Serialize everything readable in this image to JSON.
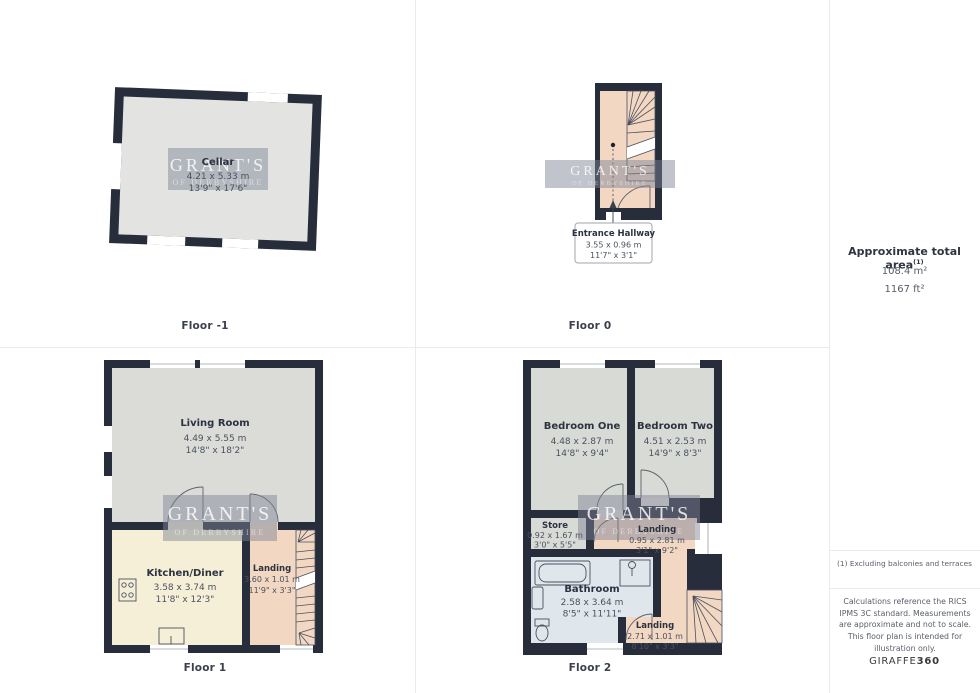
{
  "watermark": {
    "line1": "GRANT'S",
    "line2": "OF DERBYSHIRE"
  },
  "floors": {
    "fm1": {
      "label": "Floor -1",
      "rooms": {
        "cellar": {
          "name": "Cellar",
          "metric": "4.21 x 5.33 m",
          "imperial": "13'9\" x 17'6\""
        }
      }
    },
    "f0": {
      "label": "Floor 0",
      "rooms": {
        "entrance_hallway": {
          "name": "Entrance Hallway",
          "metric": "3.55 x 0.96 m",
          "imperial": "11'7\" x 3'1\""
        }
      }
    },
    "f1": {
      "label": "Floor 1",
      "rooms": {
        "living_room": {
          "name": "Living Room",
          "metric": "4.49 x 5.55 m",
          "imperial": "14'8\" x 18'2\""
        },
        "kitchen_diner": {
          "name": "Kitchen/Diner",
          "metric": "3.58 x 3.74 m",
          "imperial": "11'8\" x 12'3\""
        },
        "landing": {
          "name": "Landing",
          "metric": "3.60 x 1.01 m",
          "imperial": "11'9\" x 3'3\""
        }
      }
    },
    "f2": {
      "label": "Floor 2",
      "rooms": {
        "bedroom_one": {
          "name": "Bedroom One",
          "metric": "4.48 x 2.87 m",
          "imperial": "14'8\" x 9'4\""
        },
        "bedroom_two": {
          "name": "Bedroom Two",
          "metric": "4.51 x 2.53 m",
          "imperial": "14'9\" x 8'3\""
        },
        "store": {
          "name": "Store",
          "metric": "0.92 x 1.67 m",
          "imperial": "3'0\" x 5'5\""
        },
        "landing_mid": {
          "name": "Landing",
          "metric": "0.95 x 2.81 m",
          "imperial": "3'1\" x 9'2\""
        },
        "bathroom": {
          "name": "Bathroom",
          "metric": "2.58 x 3.64 m",
          "imperial": "8'5\" x 11'11\""
        },
        "landing_bottom": {
          "name": "Landing",
          "metric": "2.71 x 1.01 m",
          "imperial": "8'10\" x 3'3\""
        }
      }
    }
  },
  "sidebar": {
    "total_area_title": "Approximate total area",
    "total_area_footnote_marker": "(1)",
    "area_metric": "108.4 m²",
    "area_imperial": "1167 ft²",
    "footnote": "(1) Excluding balconies and terraces",
    "disclaimer": "Calculations reference the RICS IPMS 3C standard. Measurements are approximate and not to scale. This floor plan is intended for illustration only.",
    "brand_name": "GIRAFFE",
    "brand_number": "360"
  },
  "colors": {
    "wall": "#272d3b",
    "floor_grey": "#dbdcd8",
    "floor_cellar": "#e3e4e2",
    "floor_kitchen": "#f6efd7",
    "floor_landing": "#f2d7c2",
    "floor_bathroom": "#dfe7ed"
  }
}
